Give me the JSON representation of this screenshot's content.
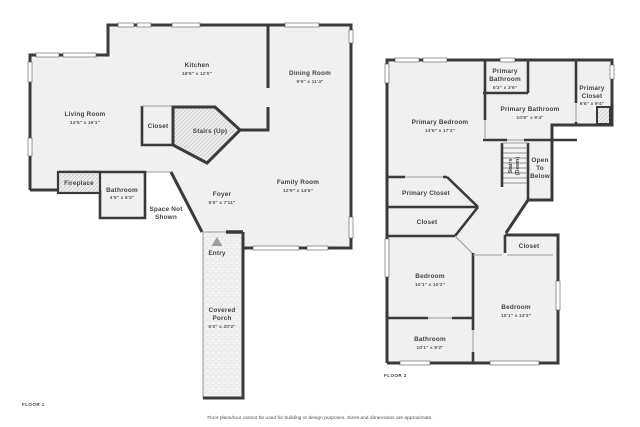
{
  "meta": {
    "floor1_label": "FLOOR 1",
    "floor2_label": "FLOOR 2",
    "disclaimer": "Floor plans/tour cannot be used for building or design purposes. Sizes and dimensions are approximate."
  },
  "colors": {
    "wall": "#383b3d",
    "room_fill": "#f0f0f0",
    "hatch_line": "#bdbdbd",
    "text": "#3f4346",
    "background": "#ffffff"
  },
  "floor1": {
    "living_room": {
      "name": "Living Room",
      "dims": "13'5\" x 16'1\""
    },
    "kitchen": {
      "name": "Kitchen",
      "dims": "18'9\" x 12'0\""
    },
    "dining_room": {
      "name": "Dining Room",
      "dims": "9'9\" x 11'4\""
    },
    "closet": {
      "name": "Closet"
    },
    "stairs": {
      "name": "Stairs (Up)"
    },
    "fireplace": {
      "name": "Fireplace"
    },
    "bathroom": {
      "name": "Bathroom",
      "dims": "4'9\" x 5'2\""
    },
    "foyer": {
      "name": "Foyer",
      "dims": "5'0\" x 7'11\""
    },
    "space_not_shown": {
      "line1": "Space Not",
      "line2": "Shown"
    },
    "family_room": {
      "name": "Family Room",
      "dims": "12'9\" x 14'6\""
    },
    "entry": {
      "name": "Entry"
    },
    "covered_porch": {
      "line1": "Covered",
      "line2": "Porch",
      "dims": "5'2\" x 20'2\""
    }
  },
  "floor2": {
    "primary_bedroom": {
      "name": "Primary Bedroom",
      "dims": "13'6\" x 17'3\""
    },
    "primary_bathroom_small": {
      "line1": "Primary",
      "line2": "Bathroom",
      "dims": "5'2\" x 3'6\""
    },
    "primary_bathroom": {
      "name": "Primary Bathroom",
      "dims": "10'8\" x 9'4\""
    },
    "primary_closet_upper": {
      "line1": "Primary",
      "line2": "Closet",
      "dims": "6'6\" x 9'4\""
    },
    "stairs": {
      "line1": "Stairs",
      "line2": "(Down)"
    },
    "open_to_below": {
      "line1": "Open",
      "line2": "To",
      "line3": "Below"
    },
    "primary_closet": {
      "name": "Primary Closet"
    },
    "closet_left": {
      "name": "Closet"
    },
    "closet_right": {
      "name": "Closet"
    },
    "bedroom_left": {
      "name": "Bedroom",
      "dims": "10'1\" x 10'2\""
    },
    "bedroom_right": {
      "name": "Bedroom",
      "dims": "10'1\" x 13'3\""
    },
    "bathroom": {
      "name": "Bathroom",
      "dims": "10'1\" x 5'2\""
    }
  }
}
